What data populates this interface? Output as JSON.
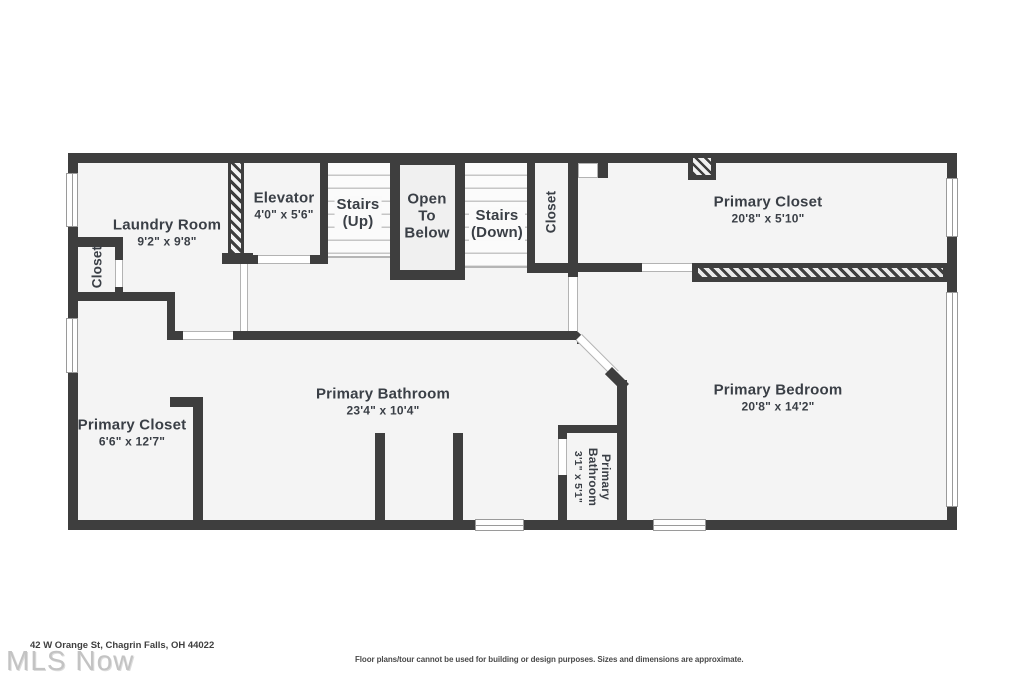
{
  "colors": {
    "wall": "#3e3e3e",
    "floor": "#f4f4f4",
    "label": "#3a3f46",
    "tread_line": "#c6c6c6",
    "window_frame": "#9a9a9a"
  },
  "rooms": {
    "laundry": {
      "name": "Laundry Room",
      "dims": "9'2\" x 9'8\""
    },
    "closet_left": {
      "name": "Closet"
    },
    "elevator": {
      "name": "Elevator",
      "dims": "4'0\" x 5'6\""
    },
    "stairs_up": {
      "label": "Stairs\n(Up)"
    },
    "open_to_below": {
      "label": "Open\nTo\nBelow"
    },
    "stairs_down": {
      "label": "Stairs\n(Down)"
    },
    "closet_top": {
      "name": "Closet"
    },
    "primary_closet_upper": {
      "name": "Primary Closet",
      "dims": "20'8\" x 5'10\""
    },
    "primary_bathroom": {
      "name": "Primary Bathroom",
      "dims": "23'4\" x 10'4\""
    },
    "primary_closet_lower": {
      "name": "Primary Closet",
      "dims": "6'6\" x 12'7\""
    },
    "primary_bedroom": {
      "name": "Primary Bedroom",
      "dims": "20'8\" x 14'2\""
    },
    "primary_bathroom_small": {
      "name": "Primary Bathroom",
      "dims": "3'1\" x 5'1\""
    }
  },
  "footer": {
    "address": "42 W Orange St, Chagrin Falls, OH 44022",
    "watermark": "MLS Now",
    "disclaimer": "Floor plans/tour cannot be used for building or design purposes. Sizes and dimensions are approximate."
  }
}
